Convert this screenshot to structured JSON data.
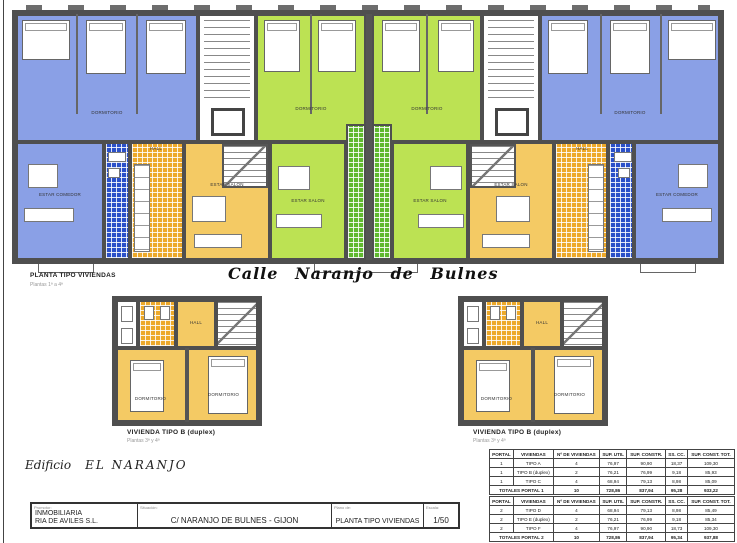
{
  "plan_header": {
    "label": "PLANTA TIPO VIVIENDAS",
    "sublabel": "Plantas 1ª a 4ª"
  },
  "street_title": "Calle  Naranjo  de  Bulnes",
  "duplex_left": {
    "label": "VIVIENDA TIPO B (duplex)",
    "sublabel": "Plantas 3ª y 4ª"
  },
  "duplex_right": {
    "label": "VIVIENDA TIPO B (duplex)",
    "sublabel": "Plantas 3ª y 4ª"
  },
  "building_label": {
    "prefix": "Edificio",
    "name": "EL NARANJO"
  },
  "room_labels": {
    "bedroom": "DORMITORIO",
    "living": "ESTAR SALON",
    "living_blue": "ESTAR COMEDOR",
    "hall": "HALL",
    "bath": "BAÑO"
  },
  "titleblock": {
    "promoter_label": "Promotor:",
    "promoter_line1": "INMOBILIARIA",
    "promoter_line2": "RIA DE AVILES S.L.",
    "location_label": "Situación:",
    "location": "C/ NARANJO DE BULNES - GIJON",
    "drawing_label": "Plano de:",
    "drawing": "PLANTA TIPO VIVIENDAS",
    "scale_label": "Escala:",
    "scale": "1/50"
  },
  "areas_table": {
    "headers": [
      "PORTAL",
      "VIVIENDAS",
      "Nº DE VIVIENDAS",
      "SUP. UTIL",
      "SUP. CONSTR.",
      "SS. CC.",
      "SUP. CONST. TOT."
    ],
    "portal1": {
      "rows": [
        [
          "1",
          "TIPO A",
          "4",
          "76,97",
          "90,90",
          "18,37",
          "109,30"
        ],
        [
          "1",
          "TIPO B (duplex)",
          "2",
          "76,21",
          "76,99",
          "9,18",
          "85,93"
        ],
        [
          "1",
          "TIPO C",
          "4",
          "68,94",
          "79,13",
          "8,98",
          "85,09"
        ]
      ],
      "totals_label": "TOTALES PORTAL 1",
      "totals": [
        "10",
        "728,86",
        "837,94",
        "95,28",
        "933,22"
      ]
    },
    "portal2": {
      "rows": [
        [
          "2",
          "TIPO D",
          "4",
          "68,94",
          "79,13",
          "8,98",
          "85,49"
        ],
        [
          "2",
          "TIPO E (duplex)",
          "2",
          "76,21",
          "76,99",
          "9,18",
          "85,34"
        ],
        [
          "2",
          "TIPO F",
          "4",
          "76,97",
          "90,90",
          "18,73",
          "109,30"
        ]
      ],
      "totals_label": "TOTALES PORTAL 2",
      "totals": [
        "10",
        "728,86",
        "837,94",
        "95,34",
        "937,88"
      ]
    },
    "grand_total_label": "TOTAL EDIFICIO",
    "grand_total": [
      "20",
      "1.457,72",
      "1.675,88",
      "184,62",
      "1.870,78"
    ]
  },
  "colors": {
    "unit_blue": "#8AA0E6",
    "unit_blue_tile": "#2B50C8",
    "unit_green": "#BCE253",
    "unit_green_tile": "#5FB92E",
    "unit_yellow": "#F4CA64",
    "unit_orange_tile": "#EDA92A",
    "walls": "#4f4f4f"
  }
}
